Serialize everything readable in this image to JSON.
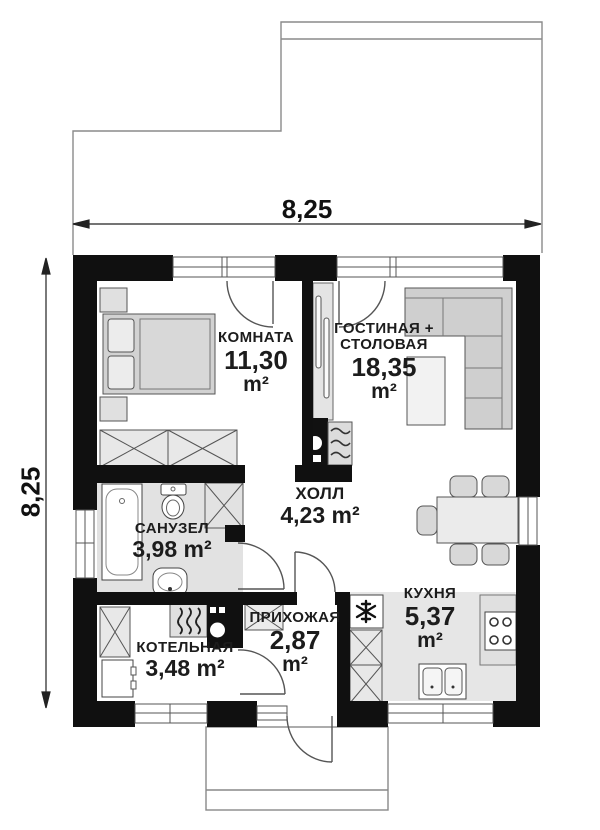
{
  "dimensions": {
    "width": "8,25",
    "height": "8,25"
  },
  "rooms": {
    "komnata": {
      "name": "КОМНАТА",
      "area": "11,30",
      "unit": "m²"
    },
    "gostinaya": {
      "name_line1": "ГОСТИНАЯ +",
      "name_line2": "СТОЛОВАЯ",
      "area": "18,35",
      "unit": "m²"
    },
    "holl": {
      "name": "ХОЛЛ",
      "area": "4,23 m²"
    },
    "sanuzel": {
      "name": "САНУЗЕЛ",
      "area": "3,98 m²"
    },
    "kuhnya": {
      "name": "КУХНЯ",
      "area": "5,37",
      "unit": "m²"
    },
    "kotelnaya": {
      "name": "КОТЕЛЬНАЯ",
      "area": "3,48 m²"
    },
    "prihozhaya": {
      "name": "ПРИХОЖАЯ",
      "area": "2,87",
      "unit": "m²"
    }
  },
  "colors": {
    "wall": "#101010",
    "wet_floor": "#e2e2e2",
    "furniture": "#d2d2d2",
    "outline": "#555555",
    "text": "#1c1c1c"
  }
}
